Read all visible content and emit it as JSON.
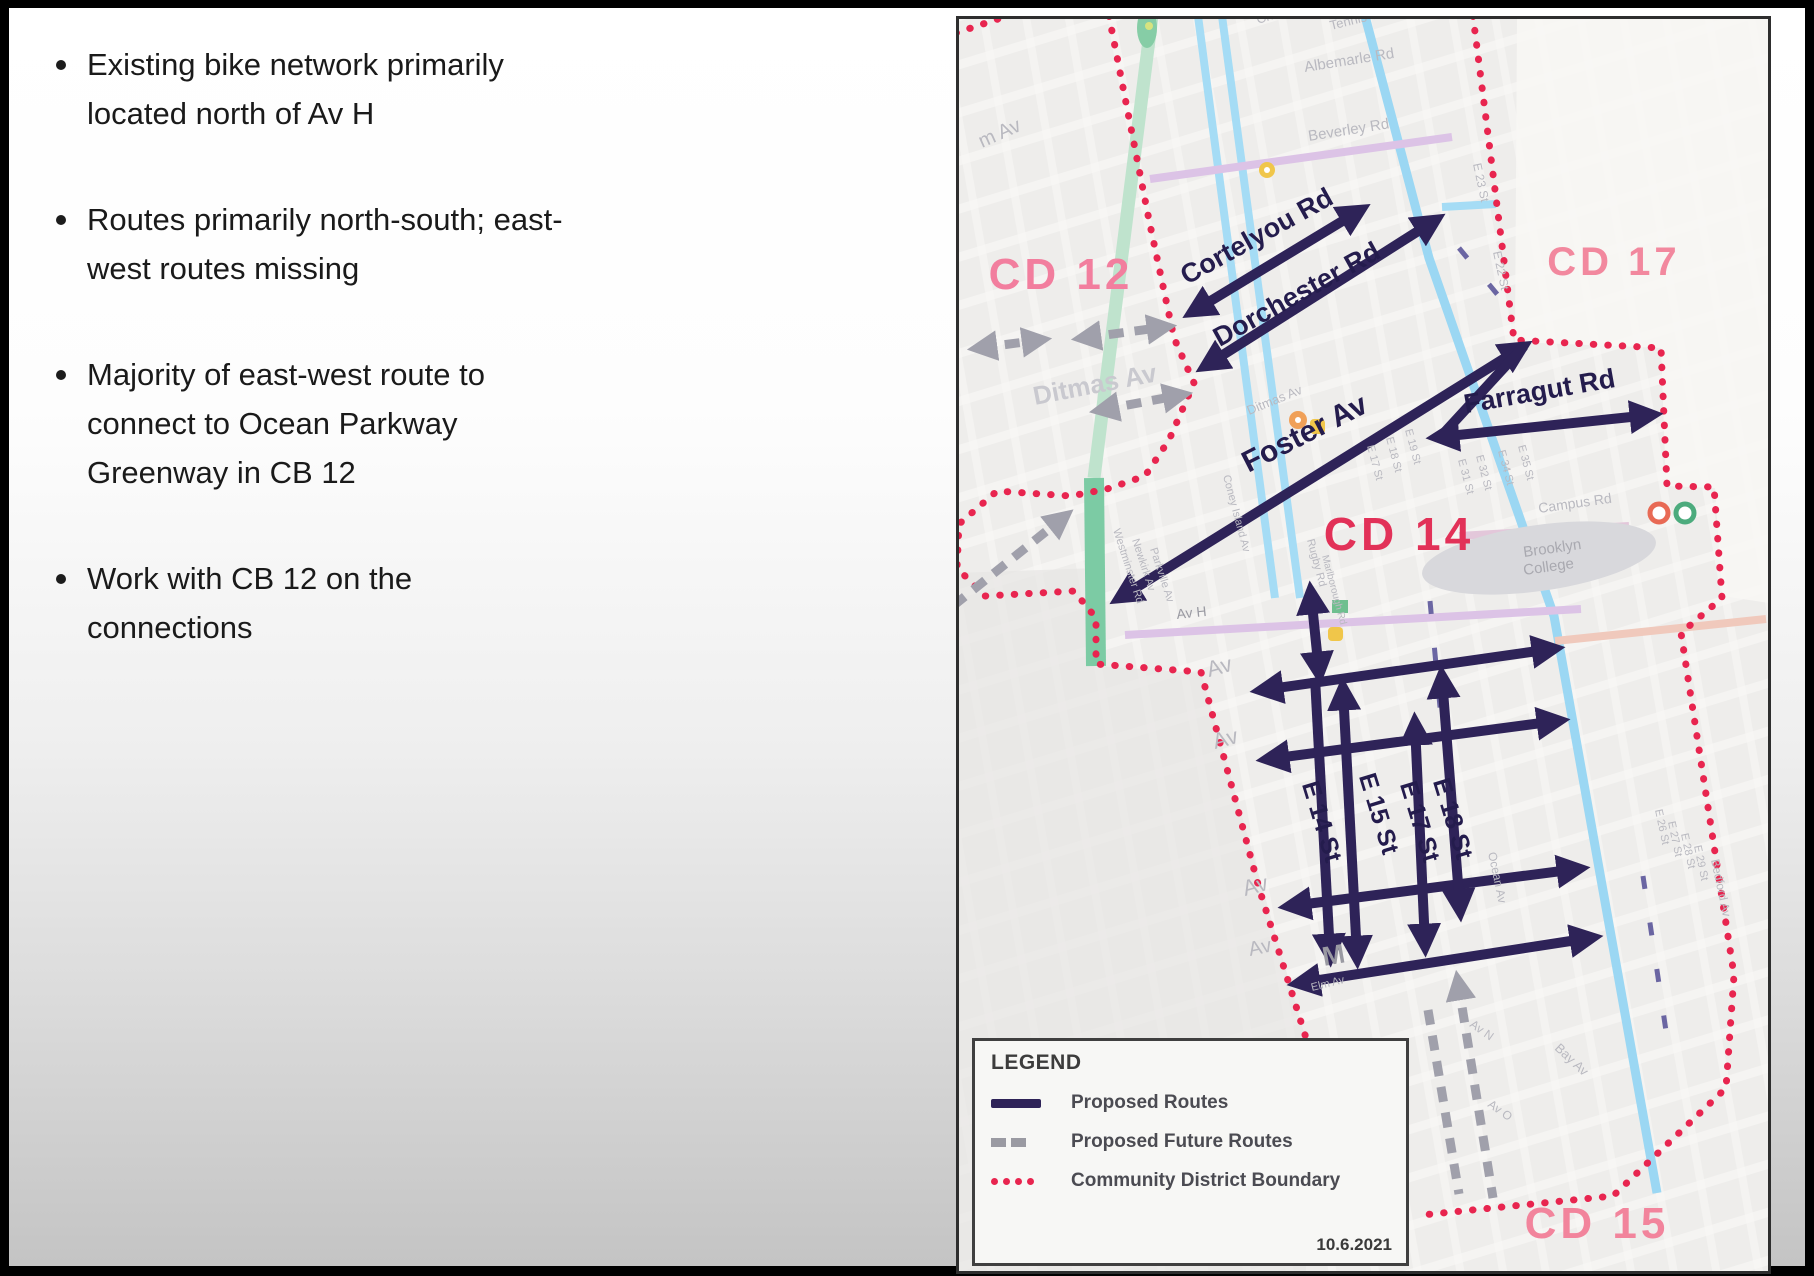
{
  "slide": {
    "bullets": [
      "Existing bike network primarily\nlocated north of Av H",
      "Routes primarily north-south; east-\nwest routes missing",
      "Majority of east-west route to\nconnect to Ocean Parkway\nGreenway in CB 12",
      "Work with CB 12 on the\nconnections"
    ]
  },
  "map": {
    "regions": {
      "cd12": "CD 12",
      "cd17": "CD 17",
      "cd14": "CD 14",
      "cd15": "CD 15"
    },
    "routes": {
      "cortelyou": "Cortelyou Rd",
      "dorchester": "Dorchester Rd",
      "foster": "Foster Av",
      "farragut": "Farragut Rd",
      "e14": "E 14 St",
      "e15": "E 15 St",
      "e17": "E 17 St",
      "e18": "E 18 St"
    },
    "streets": [
      "m Av",
      "Church Av",
      "Tennis Ct",
      "Albemarle Rd",
      "Beverley Rd",
      "E 23 St",
      "E 22 St",
      "Ditmas Av",
      "Ditmas Av",
      "Westminster Rd",
      "Newkirk Av",
      "Parkville Av",
      "Coney Island Av",
      "Rugby Rd",
      "Marlborough Rd",
      "E 17 St",
      "E 18 St",
      "E 19 St",
      "E 31 St",
      "E 32 St",
      "E 34 St",
      "E 35 St",
      "Av H",
      "Campus Rd",
      "Brooklyn",
      "College",
      "Ocean Av",
      "E 26 St",
      "E 27 St",
      "E 28 St",
      "E 29 St",
      "Bedford Av",
      "Av",
      "Av",
      "Av",
      "Av",
      "M",
      "Elm Av",
      "Av N",
      "Bay Av",
      "Av O"
    ],
    "colors": {
      "proposed_route": "#2e2358",
      "future_route": "#a0a0ab",
      "district_boundary": "#e8254f",
      "existing_route": "#9bd7f3",
      "greenway": "#7ccba4",
      "region_label_pink": "#f2849c",
      "region_label_crimson": "#e23158"
    }
  },
  "legend": {
    "title": "LEGEND",
    "items": [
      {
        "label": "Proposed Routes"
      },
      {
        "label": "Proposed Future Routes"
      },
      {
        "label": "Community District Boundary"
      }
    ],
    "date": "10.6.2021"
  }
}
